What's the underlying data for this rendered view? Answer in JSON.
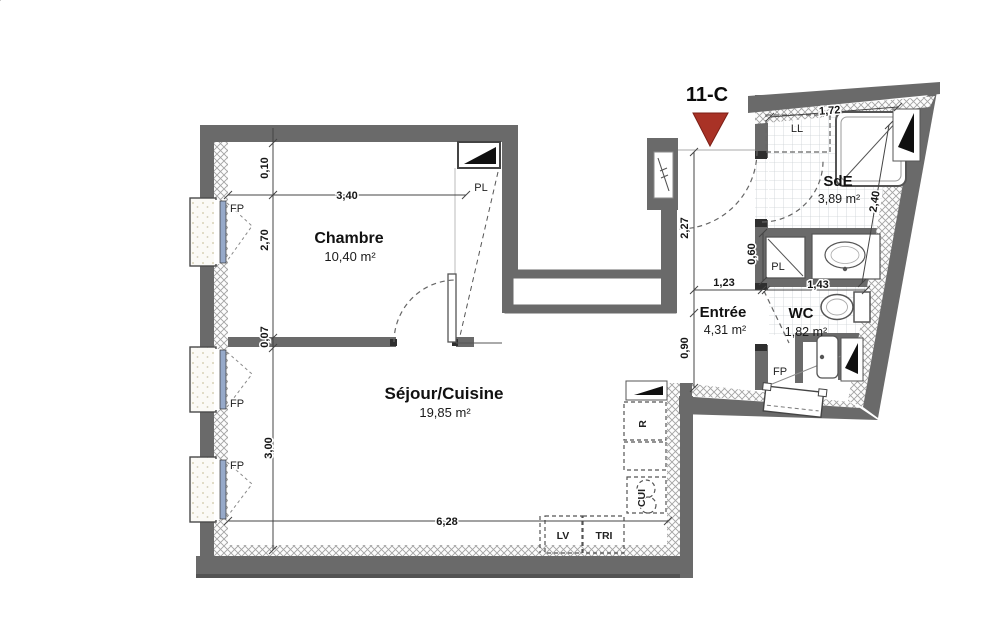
{
  "unit": "11-C",
  "rooms": {
    "chambre": {
      "name": "Chambre",
      "area": "10,40 m²"
    },
    "sejour": {
      "name": "Séjour/Cuisine",
      "area": "19,85 m²"
    },
    "entree": {
      "name": "Entrée",
      "area": "4,31 m²"
    },
    "sde": {
      "name": "SdE",
      "area": "3,89 m²"
    },
    "wc": {
      "name": "WC",
      "area": "1,82 m²"
    }
  },
  "dimensions": {
    "chambre_width": "3,40",
    "chambre_height": "2,70",
    "wall_top": "0,10",
    "wall_mid": "0,07",
    "sejour_height": "3,00",
    "sejour_width": "6,28",
    "entree_height": "2,27",
    "entree_width": "1,23",
    "passage_width": "0,90",
    "sde_width": "1,72",
    "sde_height": "2,40",
    "closet_depth": "0,60",
    "wc_width": "1,43"
  },
  "equipment": {
    "window": "FP",
    "closet": "PL",
    "washing_machine": "LL",
    "dishwasher": "LV",
    "waste_sorting": "TRI",
    "cooktop": "CUI",
    "fridge": "R"
  },
  "colors": {
    "entrance_marker": "#a93226",
    "wall": "#6a6a6a",
    "glazing": "#96a9c9"
  }
}
